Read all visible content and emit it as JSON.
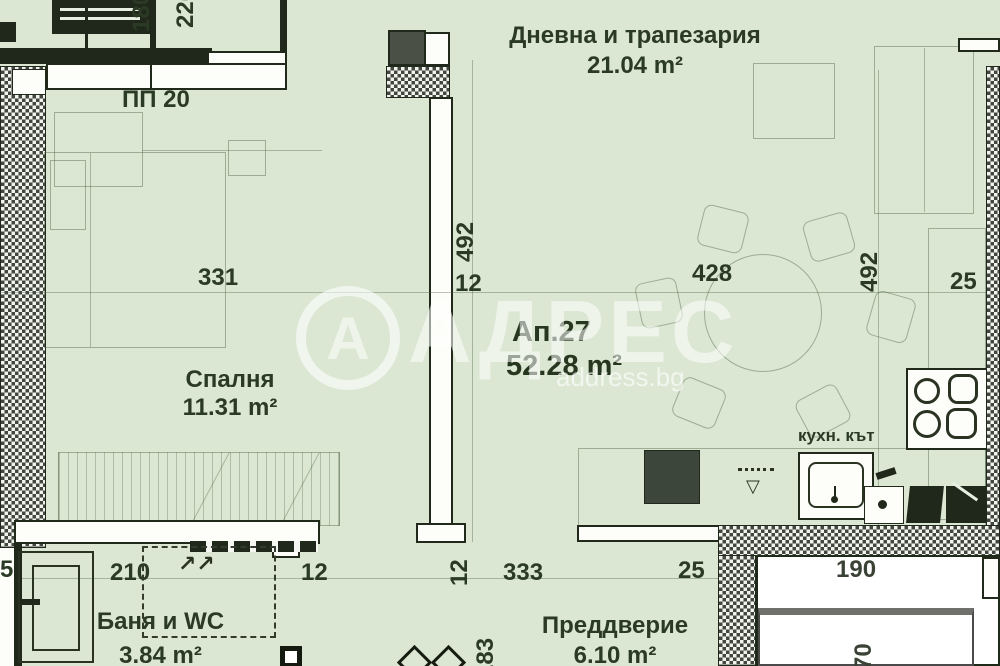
{
  "watermark": {
    "logo_letter": "А",
    "brand": "АДРЕС",
    "domain": "address.bg"
  },
  "apartment": {
    "number": "Ап.27",
    "area": "52.28 m²"
  },
  "rooms": {
    "living": {
      "name": "Дневна и трапезария",
      "area": "21.04 m²"
    },
    "bedroom": {
      "name": "Спалня",
      "area": "11.31 m²"
    },
    "bathroom": {
      "name": "Баня и WC",
      "area": "3.84 m²"
    },
    "hall": {
      "name": "Преддверие",
      "area": "6.10 m²"
    },
    "kitchen": {
      "label": "кухн. кът"
    }
  },
  "labels": {
    "pp20": "ПП 20"
  },
  "dimensions": {
    "top_180": "180",
    "top_220": "220",
    "bedroom_width": "331",
    "living_width": "428",
    "living_right_25": "25",
    "center_wall_length": "492",
    "center_wall_thickness": "12",
    "right_wall_length": "492",
    "bath_width": "210",
    "bath_right_12": "12",
    "hall_left_12": "12",
    "hall_width": "333",
    "hall_right_25": "25",
    "hall_depth": "183",
    "shaft_width": "190",
    "shaft_depth": "70",
    "left_edge_partial": "5"
  },
  "icons": {
    "vent_arrows": "↗↗",
    "basin_triangle": "▽"
  },
  "colors": {
    "background": "#dbe6d3",
    "wall_dark": "#20281c",
    "wall_white": "#fdfdfa",
    "text": "#2b3a25",
    "watermark": "#ffffff"
  }
}
